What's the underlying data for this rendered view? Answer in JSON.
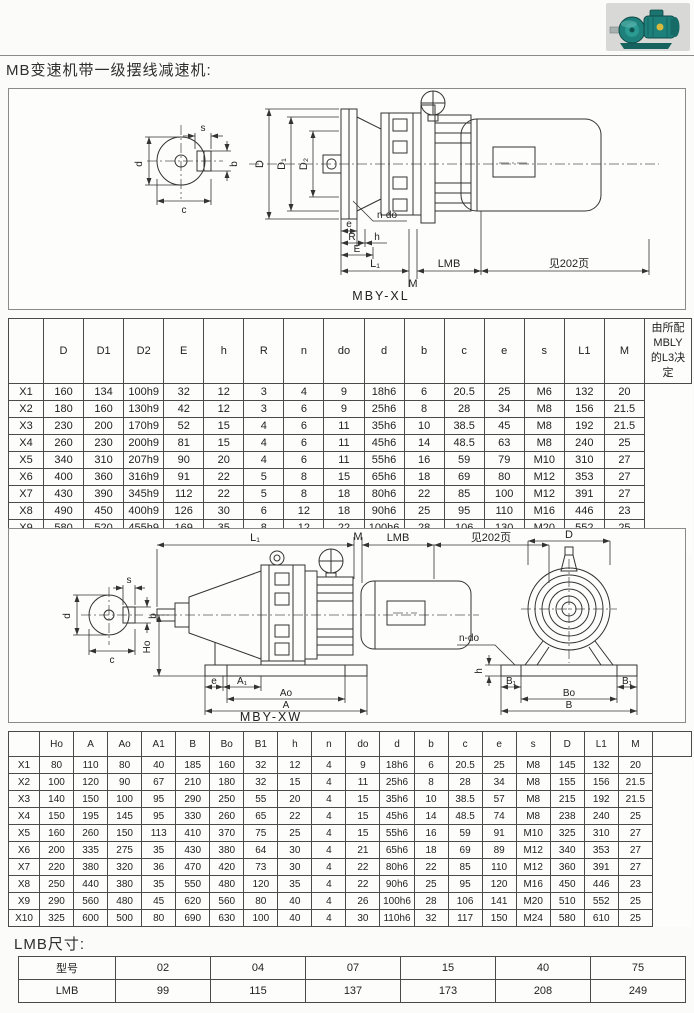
{
  "titles": {
    "main": "MB变速机带一级摆线减速机:",
    "lmb": "LMB尺寸:"
  },
  "photo": {
    "icon": "cycloid-gear-motor-photo"
  },
  "diagram_xl": {
    "caption": "MBY-XL",
    "labels": {
      "s": "s",
      "b": "b",
      "d": "d",
      "c": "c",
      "D": "D",
      "D1": "D₁",
      "D2": "D₂",
      "n_do": "n-do",
      "e": "e",
      "R": "R",
      "h": "h",
      "E": "E",
      "L1": "L₁",
      "M": "M",
      "LMB": "LMB",
      "see_page": "见202页"
    }
  },
  "diagram_xw": {
    "caption": "MBY-XW",
    "labels": {
      "s": "s",
      "b": "b",
      "d": "d",
      "c": "c",
      "L1": "L₁",
      "M": "M",
      "LMB": "LMB",
      "see_page": "见202页",
      "Ho": "Ho",
      "e": "e",
      "A1": "A₁",
      "Ao": "Ao",
      "A": "A",
      "D": "D",
      "n_do": "n-do",
      "h": "h",
      "B1_left": "B₁",
      "B1_right": "B₁",
      "Bo": "Bo",
      "B": "B"
    }
  },
  "table_xl": {
    "headers": [
      "",
      "D",
      "D1",
      "D2",
      "E",
      "h",
      "R",
      "n",
      "do",
      "d",
      "b",
      "c",
      "e",
      "s",
      "L1",
      "M"
    ],
    "rows": [
      [
        "X1",
        "160",
        "134",
        "100h9",
        "32",
        "12",
        "3",
        "4",
        "9",
        "18h6",
        "6",
        "20.5",
        "25",
        "M6",
        "132",
        "20"
      ],
      [
        "X2",
        "180",
        "160",
        "130h9",
        "42",
        "12",
        "3",
        "6",
        "9",
        "25h6",
        "8",
        "28",
        "34",
        "M8",
        "156",
        "21.5"
      ],
      [
        "X3",
        "230",
        "200",
        "170h9",
        "52",
        "15",
        "4",
        "6",
        "11",
        "35h6",
        "10",
        "38.5",
        "45",
        "M8",
        "192",
        "21.5"
      ],
      [
        "X4",
        "260",
        "230",
        "200h9",
        "81",
        "15",
        "4",
        "6",
        "11",
        "45h6",
        "14",
        "48.5",
        "63",
        "M8",
        "240",
        "25"
      ],
      [
        "X5",
        "340",
        "310",
        "207h9",
        "90",
        "20",
        "4",
        "6",
        "11",
        "55h6",
        "16",
        "59",
        "79",
        "M10",
        "310",
        "27"
      ],
      [
        "X6",
        "400",
        "360",
        "316h9",
        "91",
        "22",
        "5",
        "8",
        "15",
        "65h6",
        "18",
        "69",
        "80",
        "M12",
        "353",
        "27"
      ],
      [
        "X7",
        "430",
        "390",
        "345h9",
        "112",
        "22",
        "5",
        "8",
        "18",
        "80h6",
        "22",
        "85",
        "100",
        "M12",
        "391",
        "27"
      ],
      [
        "X8",
        "490",
        "450",
        "400h9",
        "126",
        "30",
        "6",
        "12",
        "18",
        "90h6",
        "25",
        "95",
        "110",
        "M16",
        "446",
        "23"
      ],
      [
        "X9",
        "580",
        "520",
        "455h9",
        "169",
        "35",
        "8",
        "12",
        "22",
        "100h6",
        "28",
        "106",
        "130",
        "M20",
        "552",
        "25"
      ],
      [
        "X10",
        "650",
        "590",
        "520h9",
        "174",
        "40",
        "10",
        "12",
        "22",
        "110h6",
        "32",
        "117",
        "140",
        "M24",
        "610",
        "25"
      ]
    ],
    "side_note": "由所配\nMBLY\n的L3决\n定"
  },
  "table_xw": {
    "headers": [
      "",
      "Ho",
      "A",
      "Ao",
      "A1",
      "B",
      "Bo",
      "B1",
      "h",
      "n",
      "do",
      "d",
      "b",
      "c",
      "e",
      "s",
      "D",
      "L1",
      "M"
    ],
    "rows": [
      [
        "X1",
        "80",
        "110",
        "80",
        "40",
        "185",
        "160",
        "32",
        "12",
        "4",
        "9",
        "18h6",
        "6",
        "20.5",
        "25",
        "M8",
        "145",
        "132",
        "20"
      ],
      [
        "X2",
        "100",
        "120",
        "90",
        "67",
        "210",
        "180",
        "32",
        "15",
        "4",
        "11",
        "25h6",
        "8",
        "28",
        "34",
        "M8",
        "155",
        "156",
        "21.5"
      ],
      [
        "X3",
        "140",
        "150",
        "100",
        "95",
        "290",
        "250",
        "55",
        "20",
        "4",
        "15",
        "35h6",
        "10",
        "38.5",
        "57",
        "M8",
        "215",
        "192",
        "21.5"
      ],
      [
        "X4",
        "150",
        "195",
        "145",
        "95",
        "330",
        "260",
        "65",
        "22",
        "4",
        "15",
        "45h6",
        "14",
        "48.5",
        "74",
        "M8",
        "238",
        "240",
        "25"
      ],
      [
        "X5",
        "160",
        "260",
        "150",
        "113",
        "410",
        "370",
        "75",
        "25",
        "4",
        "15",
        "55h6",
        "16",
        "59",
        "91",
        "M10",
        "325",
        "310",
        "27"
      ],
      [
        "X6",
        "200",
        "335",
        "275",
        "35",
        "430",
        "380",
        "64",
        "30",
        "4",
        "21",
        "65h6",
        "18",
        "69",
        "89",
        "M12",
        "340",
        "353",
        "27"
      ],
      [
        "X7",
        "220",
        "380",
        "320",
        "36",
        "470",
        "420",
        "73",
        "30",
        "4",
        "22",
        "80h6",
        "22",
        "85",
        "110",
        "M12",
        "360",
        "391",
        "27"
      ],
      [
        "X8",
        "250",
        "440",
        "380",
        "35",
        "550",
        "480",
        "120",
        "35",
        "4",
        "22",
        "90h6",
        "25",
        "95",
        "120",
        "M16",
        "450",
        "446",
        "23"
      ],
      [
        "X9",
        "290",
        "560",
        "480",
        "45",
        "620",
        "560",
        "80",
        "40",
        "4",
        "26",
        "100h6",
        "28",
        "106",
        "141",
        "M20",
        "510",
        "552",
        "25"
      ],
      [
        "X10",
        "325",
        "600",
        "500",
        "80",
        "690",
        "630",
        "100",
        "40",
        "4",
        "30",
        "110h6",
        "32",
        "117",
        "150",
        "M24",
        "580",
        "610",
        "25"
      ]
    ],
    "side_note": ""
  },
  "table_lmb": {
    "headers": [
      "型号",
      "02",
      "04",
      "07",
      "15",
      "40",
      "75"
    ],
    "rows": [
      [
        "LMB",
        "99",
        "115",
        "137",
        "173",
        "208",
        "249"
      ]
    ]
  }
}
